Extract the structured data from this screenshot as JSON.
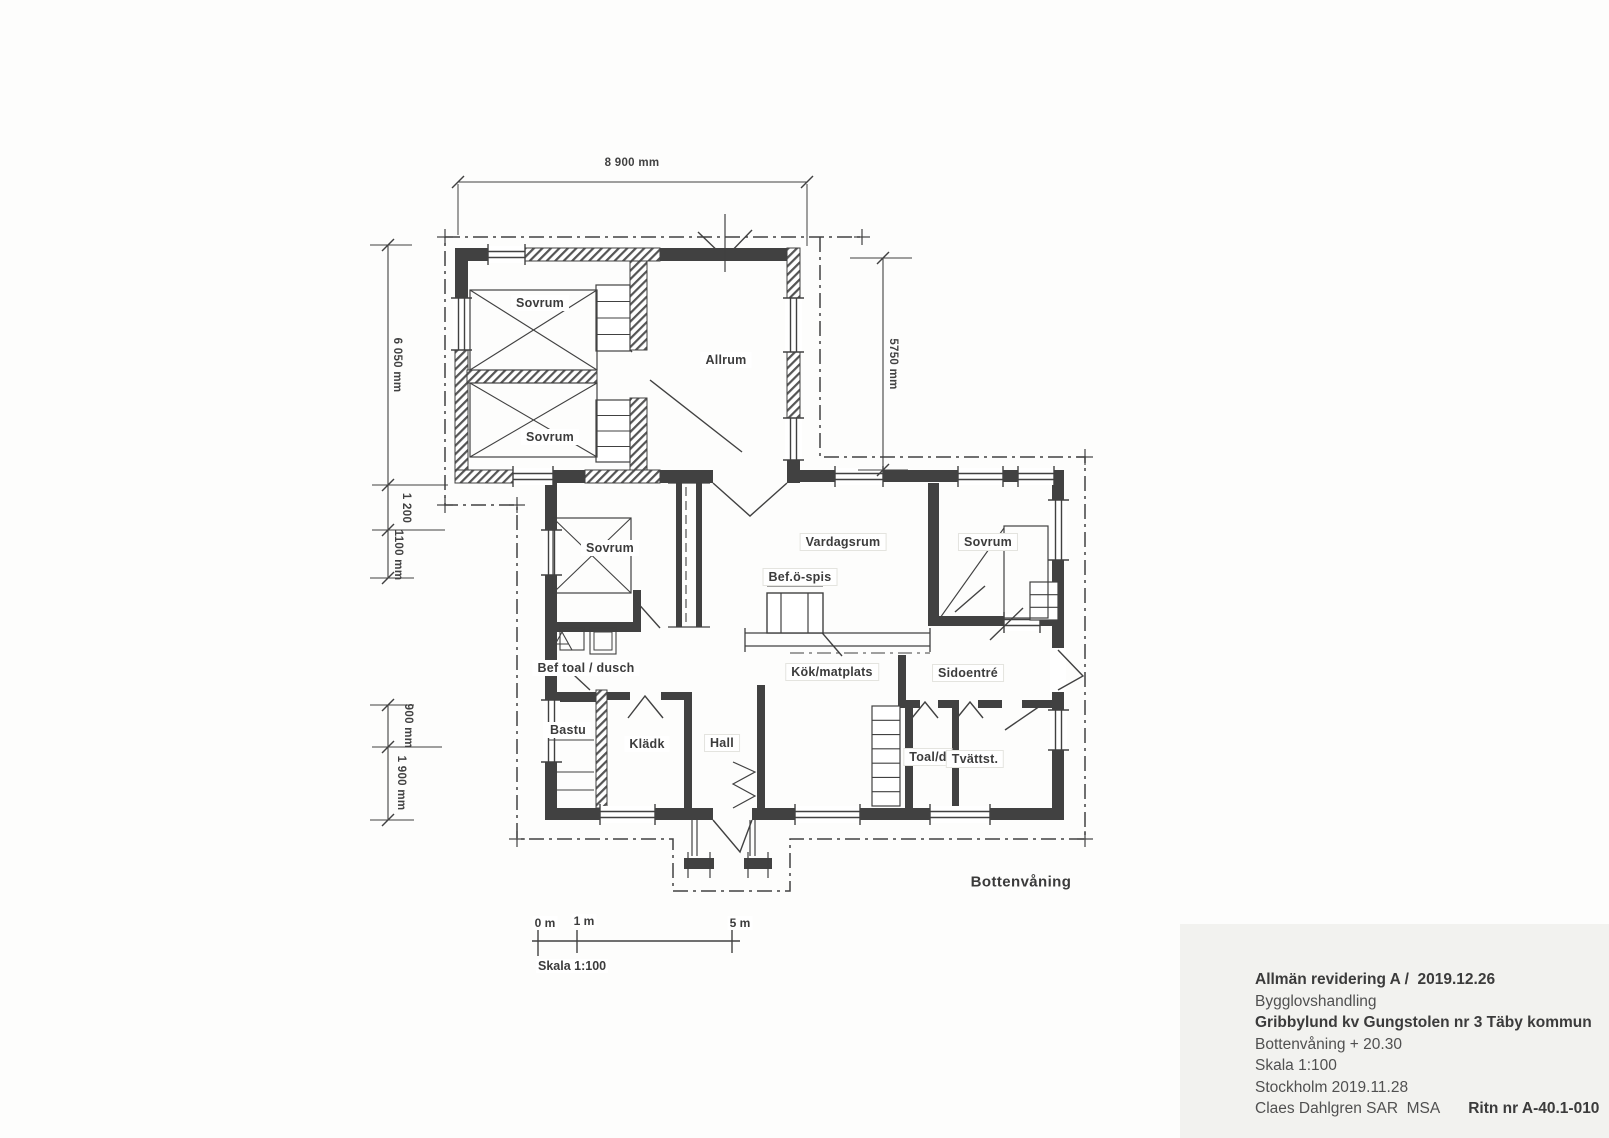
{
  "drawing": {
    "floor_label": "Bottenvåning",
    "rooms": {
      "sovrum_nw": "Sovrum",
      "allrum": "Allrum",
      "sovrum_sw": "Sovrum",
      "sovrum_mid": "Sovrum",
      "vardagsrum": "Vardagsrum",
      "bef_o_spis": "Bef.ö-spis",
      "sovrum_e": "Sovrum",
      "bef_toal_dusch": "Bef toal / dusch",
      "kok_matplats": "Kök/matplats",
      "sidoentre": "Sidoentré",
      "bastu": "Bastu",
      "kladk": "Klädk",
      "hall": "Hall",
      "toal_d": "Toal/d",
      "tvattst": "Tvättst."
    },
    "dimensions": {
      "top_width": "8 900 mm",
      "left_height": "6 050 mm",
      "left_gap_upper": "1 200",
      "left_gap_lower": "1100 mm",
      "right_height": "5750 mm",
      "lower_left_small": "900 mm",
      "lower_left_large": "1 900 mm"
    },
    "scale_bar": {
      "tick_0": "0 m",
      "tick_1": "1 m",
      "tick_5": "5 m",
      "caption": "Skala 1:100"
    }
  },
  "title_block": {
    "revision": "Allmän revidering A /  2019.12.26",
    "document_type": "Bygglovshandling",
    "project": "Gribbylund kv Gungstolen nr 3 Täby kommun",
    "floor": "Bottenvåning + 20.30",
    "scale": "Skala 1:100",
    "place_date": "Stockholm 2019.11.28",
    "architect": "Claes Dahlgren SAR  MSA",
    "drawing_number": "Ritn nr A-40.1-010"
  },
  "colors": {
    "ink": "#414141",
    "paper": "#fdfdfc",
    "panel": "#f2f2ef"
  }
}
